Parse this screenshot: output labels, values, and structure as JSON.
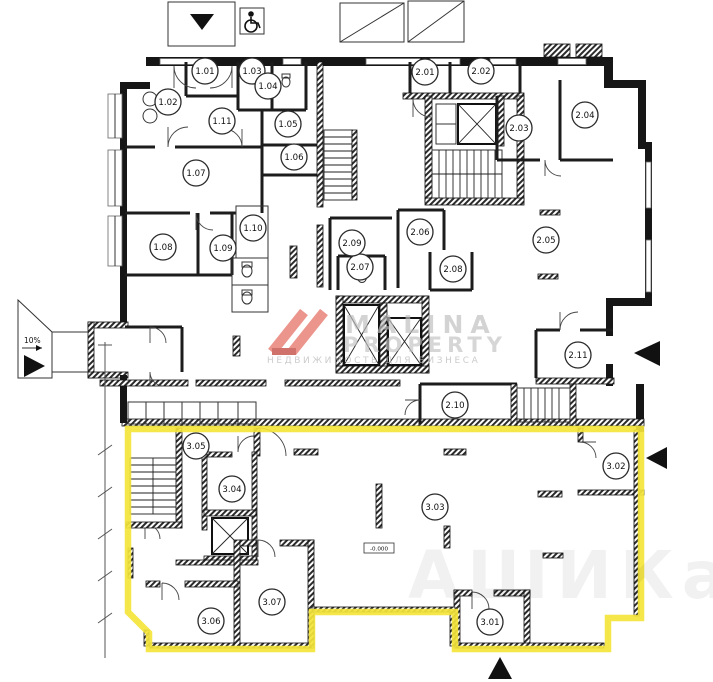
{
  "plan_title": "floor-plan",
  "highlight_color": "#f4e53a",
  "ramp": {
    "slope_label": "10%"
  },
  "level_mark": "-0.000",
  "watermark": {
    "brand_line1": "MALINA",
    "brand_line2": "PROPERTY",
    "tagline": "НЕДВИЖИМОСТЬ ДЛЯ БИЗНЕСА",
    "logo_color": "#e8837a",
    "text_color": "#c3c3c3"
  },
  "faint_watermark": "АШИКаН",
  "rooms": [
    {
      "id": "1.01",
      "x": 205,
      "y": 71
    },
    {
      "id": "1.02",
      "x": 168,
      "y": 102
    },
    {
      "id": "1.03",
      "x": 252,
      "y": 71
    },
    {
      "id": "1.04",
      "x": 268,
      "y": 86
    },
    {
      "id": "1.05",
      "x": 288,
      "y": 124
    },
    {
      "id": "1.06",
      "x": 294,
      "y": 157
    },
    {
      "id": "1.07",
      "x": 196,
      "y": 173
    },
    {
      "id": "1.08",
      "x": 163,
      "y": 247
    },
    {
      "id": "1.09",
      "x": 223,
      "y": 248
    },
    {
      "id": "1.10",
      "x": 253,
      "y": 228
    },
    {
      "id": "1.11",
      "x": 222,
      "y": 121
    },
    {
      "id": "2.01",
      "x": 425,
      "y": 72
    },
    {
      "id": "2.02",
      "x": 481,
      "y": 71
    },
    {
      "id": "2.03",
      "x": 519,
      "y": 128
    },
    {
      "id": "2.04",
      "x": 585,
      "y": 115
    },
    {
      "id": "2.05",
      "x": 546,
      "y": 240
    },
    {
      "id": "2.06",
      "x": 420,
      "y": 232
    },
    {
      "id": "2.07",
      "x": 360,
      "y": 267
    },
    {
      "id": "2.08",
      "x": 453,
      "y": 269
    },
    {
      "id": "2.09",
      "x": 352,
      "y": 243
    },
    {
      "id": "2.10",
      "x": 455,
      "y": 405
    },
    {
      "id": "2.11",
      "x": 578,
      "y": 355
    },
    {
      "id": "3.01",
      "x": 490,
      "y": 622
    },
    {
      "id": "3.02",
      "x": 616,
      "y": 466
    },
    {
      "id": "3.03",
      "x": 435,
      "y": 507
    },
    {
      "id": "3.04",
      "x": 232,
      "y": 489
    },
    {
      "id": "3.05",
      "x": 196,
      "y": 446
    },
    {
      "id": "3.06",
      "x": 211,
      "y": 621
    },
    {
      "id": "3.07",
      "x": 272,
      "y": 602
    }
  ],
  "arrows": [
    {
      "name": "entrance-arrow-top",
      "points": "190,14 214,14 202,30"
    },
    {
      "name": "ramp-arrow-left",
      "points": "24,355 24,377 45,366"
    },
    {
      "name": "entrance-arrow-right-upper",
      "points": "660,341 660,366 634,353"
    },
    {
      "name": "entrance-arrow-right-lower",
      "points": "667,447 667,469 646,458"
    },
    {
      "name": "entrance-arrow-bottom",
      "points": "488,679 512,679 500,657"
    }
  ]
}
